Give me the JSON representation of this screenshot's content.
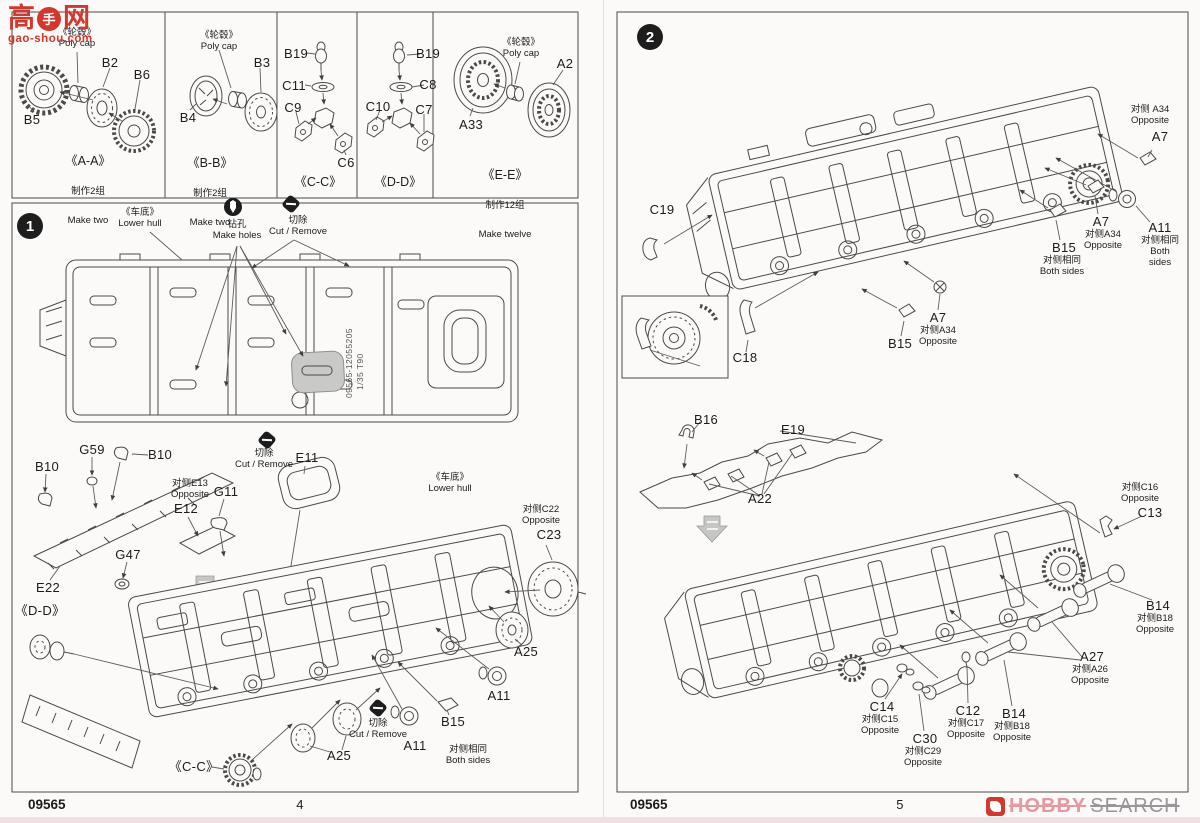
{
  "colors": {
    "ink": "#4a4a4a",
    "watermark_red": "#d4372b",
    "hobby_pink": "#e59aa2",
    "hobby_gray": "#97979b"
  },
  "watermark_gaoshou": {
    "char_left": "高",
    "char_badge": "手",
    "char_right": "网",
    "domain": "gao-shou.com"
  },
  "watermark_hobby": {
    "word1": "HOBBY",
    "word2": "SEARCH"
  },
  "footer": {
    "kit": "09565",
    "page_left": "4",
    "page_right": "5"
  },
  "parts_boxes": [
    {
      "caption": "《A-A》",
      "make_cn": "制作2组",
      "make_en": "Make two",
      "polycap": "《轮毂》\nPoly cap",
      "parts": {
        "b5": "B5",
        "b2": "B2",
        "b6": "B6"
      }
    },
    {
      "caption": "《B-B》",
      "make_cn": "制作2组",
      "make_en": "Make two",
      "polycap": "《轮毂》\nPoly cap",
      "parts": {
        "b4": "B4",
        "b3": "B3"
      }
    },
    {
      "caption": "《C-C》",
      "parts": {
        "b19": "B19",
        "c11": "C11",
        "c9": "C9",
        "c6": "C6"
      }
    },
    {
      "caption": "《D-D》",
      "parts": {
        "b19": "B19",
        "c8": "C8",
        "c10": "C10",
        "c7": "C7"
      }
    },
    {
      "caption": "《E-E》",
      "make_cn": "制作12组",
      "make_en": "Make twelve",
      "polycap": "《轮毂》\nPoly cap",
      "parts": {
        "a33": "A33",
        "a2": "A2"
      }
    }
  ],
  "step1": {
    "number": "1",
    "notes": {
      "lower_hull": "《车底》\nLower hull",
      "make_holes": "钻孔\nMake holes",
      "cut_remove": "切除\nCut / Remove",
      "both_sides": "对侧相同\nBoth sides"
    },
    "hull_marking_line1": "09565-12055205",
    "hull_marking_line2": "1/35  T90",
    "labels": {
      "b10": "B10",
      "g59": "G59",
      "e11": "E11",
      "opp_e13": "对侧E13\nOpposite",
      "e12": "E12",
      "g11": "G11",
      "g47": "G47",
      "e22": "E22",
      "dd_ref": "《D-D》",
      "cc_ref": "《C-C》",
      "opp_c22": "对侧C22\nOpposite",
      "c23": "C23",
      "a25": "A25",
      "a11": "A11",
      "b15": "B15"
    }
  },
  "step2": {
    "number": "2",
    "labels": {
      "opp_a34_top": "对侧 A34\nOpposite",
      "opp_a34": "对侧A34\nOpposite",
      "a7": "A7",
      "a11": "A11",
      "b15": "B15",
      "both_sides": "对侧相同\nBoth sides",
      "c19": "C19",
      "c18": "C18",
      "b16": "B16",
      "e19": "E19",
      "a22": "A22",
      "opp_c16": "对侧C16\nOpposite",
      "c13": "C13",
      "b14": "B14",
      "opp_b18": "对侧B18\nOpposite",
      "a27": "A27",
      "opp_a26": "对侧A26\nOpposite",
      "c14": "C14",
      "opp_c15": "对侧C15\nOpposite",
      "c30": "C30",
      "opp_c29": "对侧C29\nOpposite",
      "c12": "C12",
      "opp_c17": "对侧C17\nOpposite"
    }
  }
}
